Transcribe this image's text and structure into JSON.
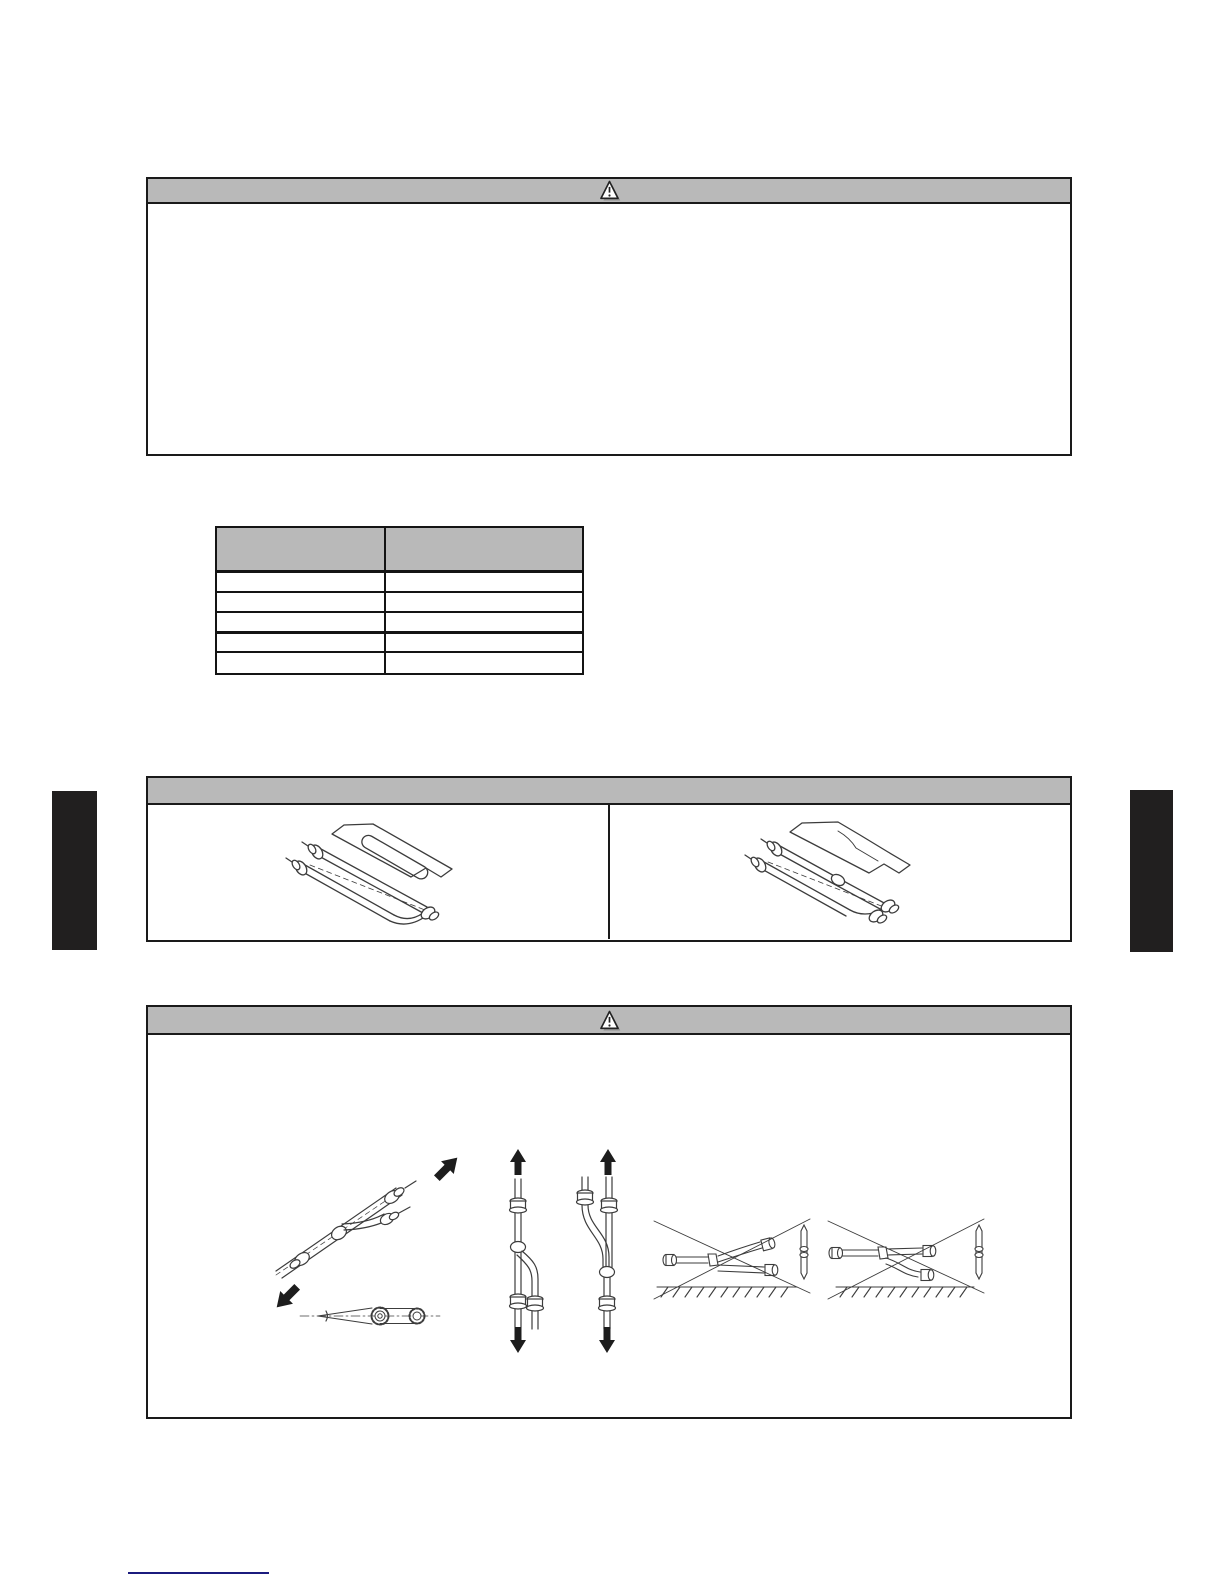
{
  "page": {
    "background": "#ffffff",
    "colors": {
      "box_border": "#1a1a1a",
      "header_gray": "#b9b9b9",
      "line_art": "#3c3c3c",
      "arrow_black": "#1d1d1d",
      "side_tab_black": "#211f1f",
      "footer_line_navy": "#1b1b7e"
    }
  },
  "warning_box": {
    "icon": "warning-triangle",
    "header_text": "",
    "body_text": ""
  },
  "spec_table": {
    "header": [
      "",
      ""
    ],
    "rows": [
      [
        "",
        ""
      ],
      [
        "",
        ""
      ],
      [
        "",
        ""
      ],
      [
        "",
        ""
      ],
      [
        "",
        ""
      ]
    ]
  },
  "branch_pipe_panel": {
    "header_text": "",
    "cells": [
      {
        "figure": "y-branch-pipe-kit-isometric"
      },
      {
        "figure": "y-branch-pipe-kit-isometric-variant"
      }
    ]
  },
  "caution_box": {
    "icon": "warning-triangle",
    "header_text": "",
    "body_text": "",
    "figures": [
      "diagonal-installation-allowed-with-arrows",
      "branch-angle-tolerance-end-view",
      "vertical-installation-branch-downward",
      "vertical-installation-branch-upward",
      "horizontal-installation-prohibited-crossed-out-1",
      "horizontal-installation-prohibited-crossed-out-2"
    ]
  },
  "side_tabs": {
    "left": "",
    "right": ""
  },
  "footer": {
    "link_text": ""
  }
}
